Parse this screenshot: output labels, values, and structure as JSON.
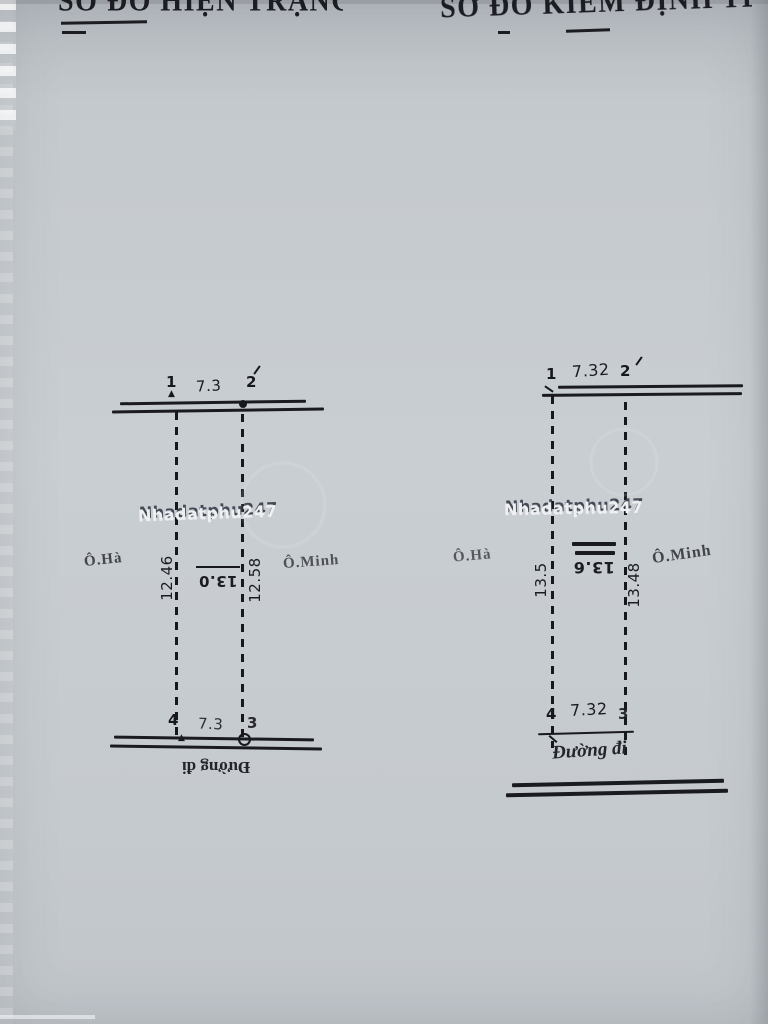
{
  "document": {
    "heading_left": "SƠ ĐỒ HIỆN TRẠNG TL 1/500",
    "heading_right": "SƠ ĐỒ KIỂM ĐỊNH TL 1/50",
    "watermark": "Nhadatphu247",
    "colors": {
      "paper": "#c7ccd0",
      "ink": "#17181c",
      "watermark_fill": "#eef0f2",
      "watermark_shadow": "#343a46"
    }
  },
  "plot_left": {
    "corner_top_left": "1",
    "corner_top_right": "2",
    "corner_bottom_left": "4",
    "corner_bottom_right": "3",
    "dim_top": "7.3",
    "dim_bottom": "7.3",
    "dim_left": "12.46",
    "dim_right": "12.58",
    "dim_center": "13.0",
    "neighbor_left": "Ô.Hà",
    "neighbor_right": "Ô.Minh",
    "road_label": "Đường đi"
  },
  "plot_right": {
    "corner_top_left": "1",
    "corner_top_right": "2",
    "corner_bottom_left": "4",
    "corner_bottom_right": "3",
    "dim_top": "7.32",
    "dim_bottom": "7.32",
    "dim_left": "13.5",
    "dim_right": "13.48",
    "dim_center": "13.6",
    "neighbor_left": "Ô.Hà",
    "neighbor_right": "Ô.Minh",
    "road_label": "Đường đi"
  }
}
